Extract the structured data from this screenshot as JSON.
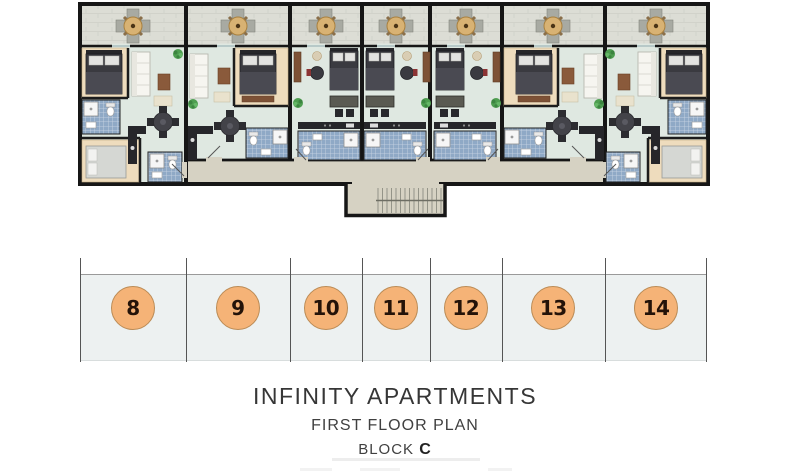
{
  "titles": {
    "building_name": "INFINITY APARTMENTS",
    "plan_name": "FIRST FLOOR PLAN",
    "block_prefix": "BLOCK",
    "block_letter": "C"
  },
  "units": [
    {
      "number": "8"
    },
    {
      "number": "9"
    },
    {
      "number": "10"
    },
    {
      "number": "11"
    },
    {
      "number": "12"
    },
    {
      "number": "13"
    },
    {
      "number": "14"
    }
  ],
  "floor_plan": {
    "apartment_count": 7,
    "colors": {
      "wall": "#161616",
      "balcony_floor": "#dcddd5",
      "interior_floor": "#dfe8e1",
      "bedroom_floor": "#eedcbd",
      "bathroom_tile": "#8fa9c6",
      "corridor_floor": "#d6d2c3",
      "unit_badge_fill": "#f5b377",
      "unit_badge_border": "#bb8b55",
      "unit_badge_text": "#241309"
    }
  }
}
